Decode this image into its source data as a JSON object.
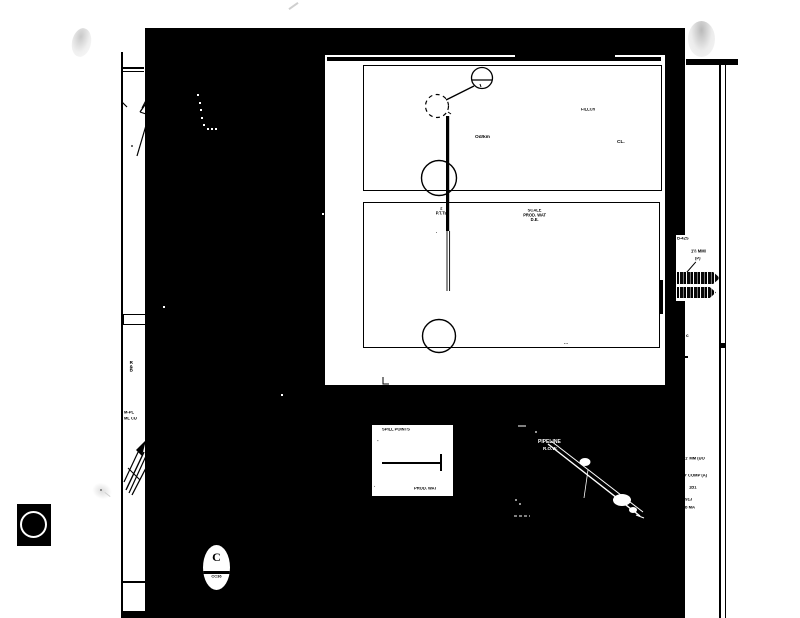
{
  "colors": {
    "paper": "#ffffff",
    "ink": "#000000",
    "scan_black": "#000000",
    "artifact_gray": "#d9d9d9"
  },
  "panel": {
    "upper": {
      "label_field": "FILLCh",
      "label_center": "Od/km",
      "label_right": "CL."
    },
    "lower": {
      "stack_top": "2",
      "stack_bottom": "P.T.Ts",
      "center_line_1": "SCALE",
      "center_line_2": "PROD. WAT",
      "center_line_3": "D.E.",
      "dot": ".",
      "ellipsis": "..."
    }
  },
  "scale_box": {
    "title": "SPILL POINTS",
    "left_tick": "-",
    "corner_mark": "·",
    "bottom_label": "PROD. WAT"
  },
  "profile": {
    "label_line_1": "PIPELINE",
    "label_line_2": "R.O.W."
  },
  "callout": {
    "code": "B-42S",
    "note_line_1": "1½ MMI",
    "note_line_2": "(P)"
  },
  "right_margin": {
    "mark": "c",
    "lines": [
      "DDJ",
      "1' MM (UO",
      "U' COMP (A)",
      "1B1",
      "T. 91J",
      "b MA"
    ]
  },
  "left_margin": {
    "vertical_note": "R&B",
    "note_line_1": "M-PL",
    "note_line_2": "ML CU"
  },
  "stamp": {
    "letter": "C",
    "code": "CC36"
  }
}
